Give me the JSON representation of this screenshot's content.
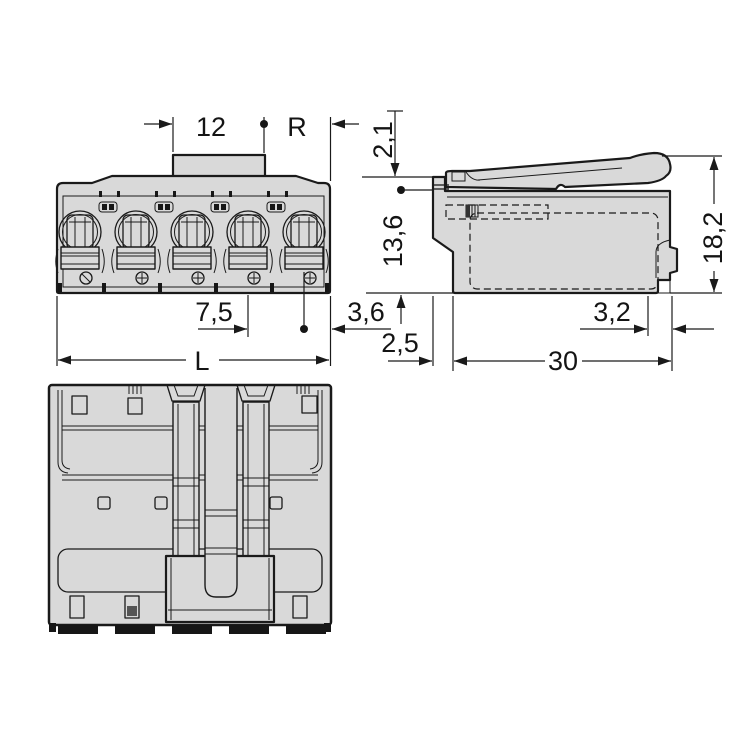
{
  "drawing": {
    "type": "connector-dimension-drawing",
    "colors": {
      "body_fill": "#d9d9d9",
      "line": "#1a1a1a",
      "dark_detail": "#161616",
      "background": "#ffffff"
    },
    "views": {
      "front": {
        "dims": {
          "coding_width": "12",
          "pin_ref": "R",
          "pitch": "7,5",
          "edge_offset": "3,6",
          "total_length": "L"
        }
      },
      "side": {
        "dims": {
          "top_offset": "2,1",
          "pin_to_bottom": "13,6",
          "height": "18,2",
          "notch": "3,2",
          "face_offset": "2,5",
          "depth": "30"
        }
      }
    }
  }
}
